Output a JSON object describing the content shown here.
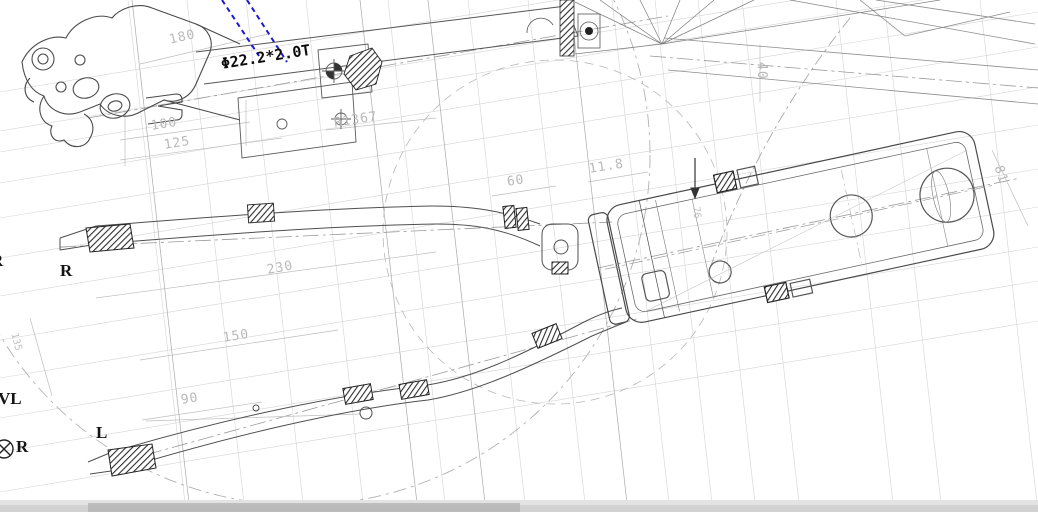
{
  "drawing": {
    "type": "engineering-cad-drawing",
    "subject": "bicycle frame rear swing-arm and tube assembly, top view",
    "callout": {
      "text": "Φ22.2*2.0T"
    },
    "dimensions": [
      {
        "text": "180",
        "x": 168,
        "y": 34,
        "rot": -13,
        "kind": "dim"
      },
      {
        "text": "100",
        "x": 150,
        "y": 120,
        "rot": -9,
        "kind": "dim"
      },
      {
        "text": "125",
        "x": 163,
        "y": 139,
        "rot": -9,
        "kind": "dim"
      },
      {
        "text": "R1367",
        "x": 333,
        "y": 117,
        "rot": -9,
        "kind": "dim"
      },
      {
        "text": "60",
        "x": 506,
        "y": 176,
        "rot": -9,
        "kind": "dim"
      },
      {
        "text": "11.8",
        "x": 588,
        "y": 163,
        "rot": -9,
        "kind": "dim"
      },
      {
        "text": "40",
        "x": 768,
        "y": 62,
        "rot": 90,
        "kind": "dim"
      },
      {
        "text": "76",
        "x": 700,
        "y": 206,
        "rot": 83,
        "kind": "dim-sm"
      },
      {
        "text": "81",
        "x": 1004,
        "y": 164,
        "rot": 72,
        "kind": "dim"
      },
      {
        "text": "230",
        "x": 266,
        "y": 264,
        "rot": -10,
        "kind": "dim"
      },
      {
        "text": "150",
        "x": 222,
        "y": 332,
        "rot": -9,
        "kind": "dim"
      },
      {
        "text": "90",
        "x": 180,
        "y": 394,
        "rot": -9,
        "kind": "dim"
      },
      {
        "text": "135",
        "x": 18,
        "y": 332,
        "rot": 75,
        "kind": "dim-sm"
      }
    ],
    "side_labels": [
      {
        "text": "R",
        "x": -9,
        "y": 252,
        "rot": 0,
        "kind": "letter"
      },
      {
        "text": "R",
        "x": 60,
        "y": 262,
        "rot": 0,
        "kind": "letter"
      },
      {
        "text": "VL",
        "x": -2,
        "y": 390,
        "rot": 0,
        "kind": "letter"
      },
      {
        "text": "L",
        "x": 96,
        "y": 424,
        "rot": 0,
        "kind": "letter"
      },
      {
        "text": "R",
        "x": 16,
        "y": 438,
        "rot": 0,
        "kind": "letter"
      }
    ],
    "colors": {
      "leader_blue": "#1a1ad0",
      "outline": "#4a4a4a",
      "construction": "#cccccc",
      "dim_text": "#b9b9b9",
      "callout_text": "#0d0d0d",
      "bottom_band": "#d2d2d2",
      "bottom_bar": "#b2b2b2"
    }
  }
}
